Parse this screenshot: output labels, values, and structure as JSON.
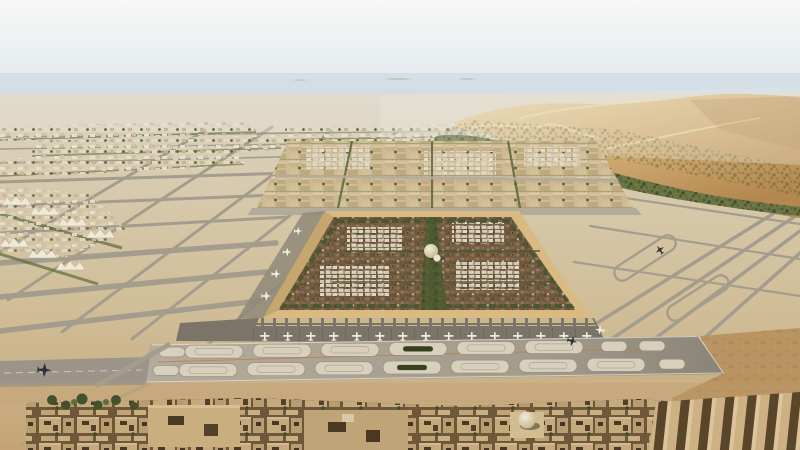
{
  "scene": {
    "kind": "aerial-architectural-render",
    "setting": "desert-airport-city-masterplan",
    "regions": {
      "sky": "hazy pale sky",
      "horizon": "distant landforms in blue haze",
      "dunes": "golden sand dunes right side",
      "wadi": "green vegetation belt at dune base",
      "airfield": "grid of runways and taxiways",
      "walled_city": "large square walled old town with dome",
      "apron": "aircraft gates along city wall",
      "loop_band": "wide taxiway band with oval islands",
      "foreground": "low-rise courtyard buildings with small dome"
    }
  },
  "colors": {
    "sky_top": "#f6f7f6",
    "sky_mid": "#eaeff2",
    "sky_low": "#dbe4eb",
    "haze": "#c7d3dd",
    "hill": "#b6c0c8",
    "plain": "#dcd5c6",
    "sand_mid": "#d6c8aa",
    "sand_low": "#d0bd97",
    "sand_fore": "#c4a476",
    "dune_light": "#ecd9ad",
    "dune_mid": "#d4af78",
    "dune_deep": "#b3874e",
    "wadi": "#6d7547",
    "taxiway": "#a49c8c",
    "runway": "#9c9488",
    "band_light": "#b4ad9d",
    "band_dark": "#8a8477",
    "island": "#d8d0bd",
    "island_green": "#37411f",
    "wall": "#d8ba82",
    "wall_shade": "#b99a63",
    "medina": "#6a543c",
    "white_roof": "#ddd6c5",
    "block": "#cdbb96",
    "street": "#b3ab9a",
    "apron": "#7b7569",
    "canopy": "#cbb78e",
    "green_street": "#57663a",
    "spine": "#4c5a31",
    "fg_base": "#6f5839",
    "fg_block": "#c4aa7d",
    "slab_gap": "#5a452b",
    "rough": "#b78f5c",
    "plane_light": "#f0eee3",
    "plane_dark": "#31353a",
    "orange_line": "#bd7d3e",
    "dome_hi": "#f2ebd9",
    "dome_lo": "#bca97f"
  }
}
